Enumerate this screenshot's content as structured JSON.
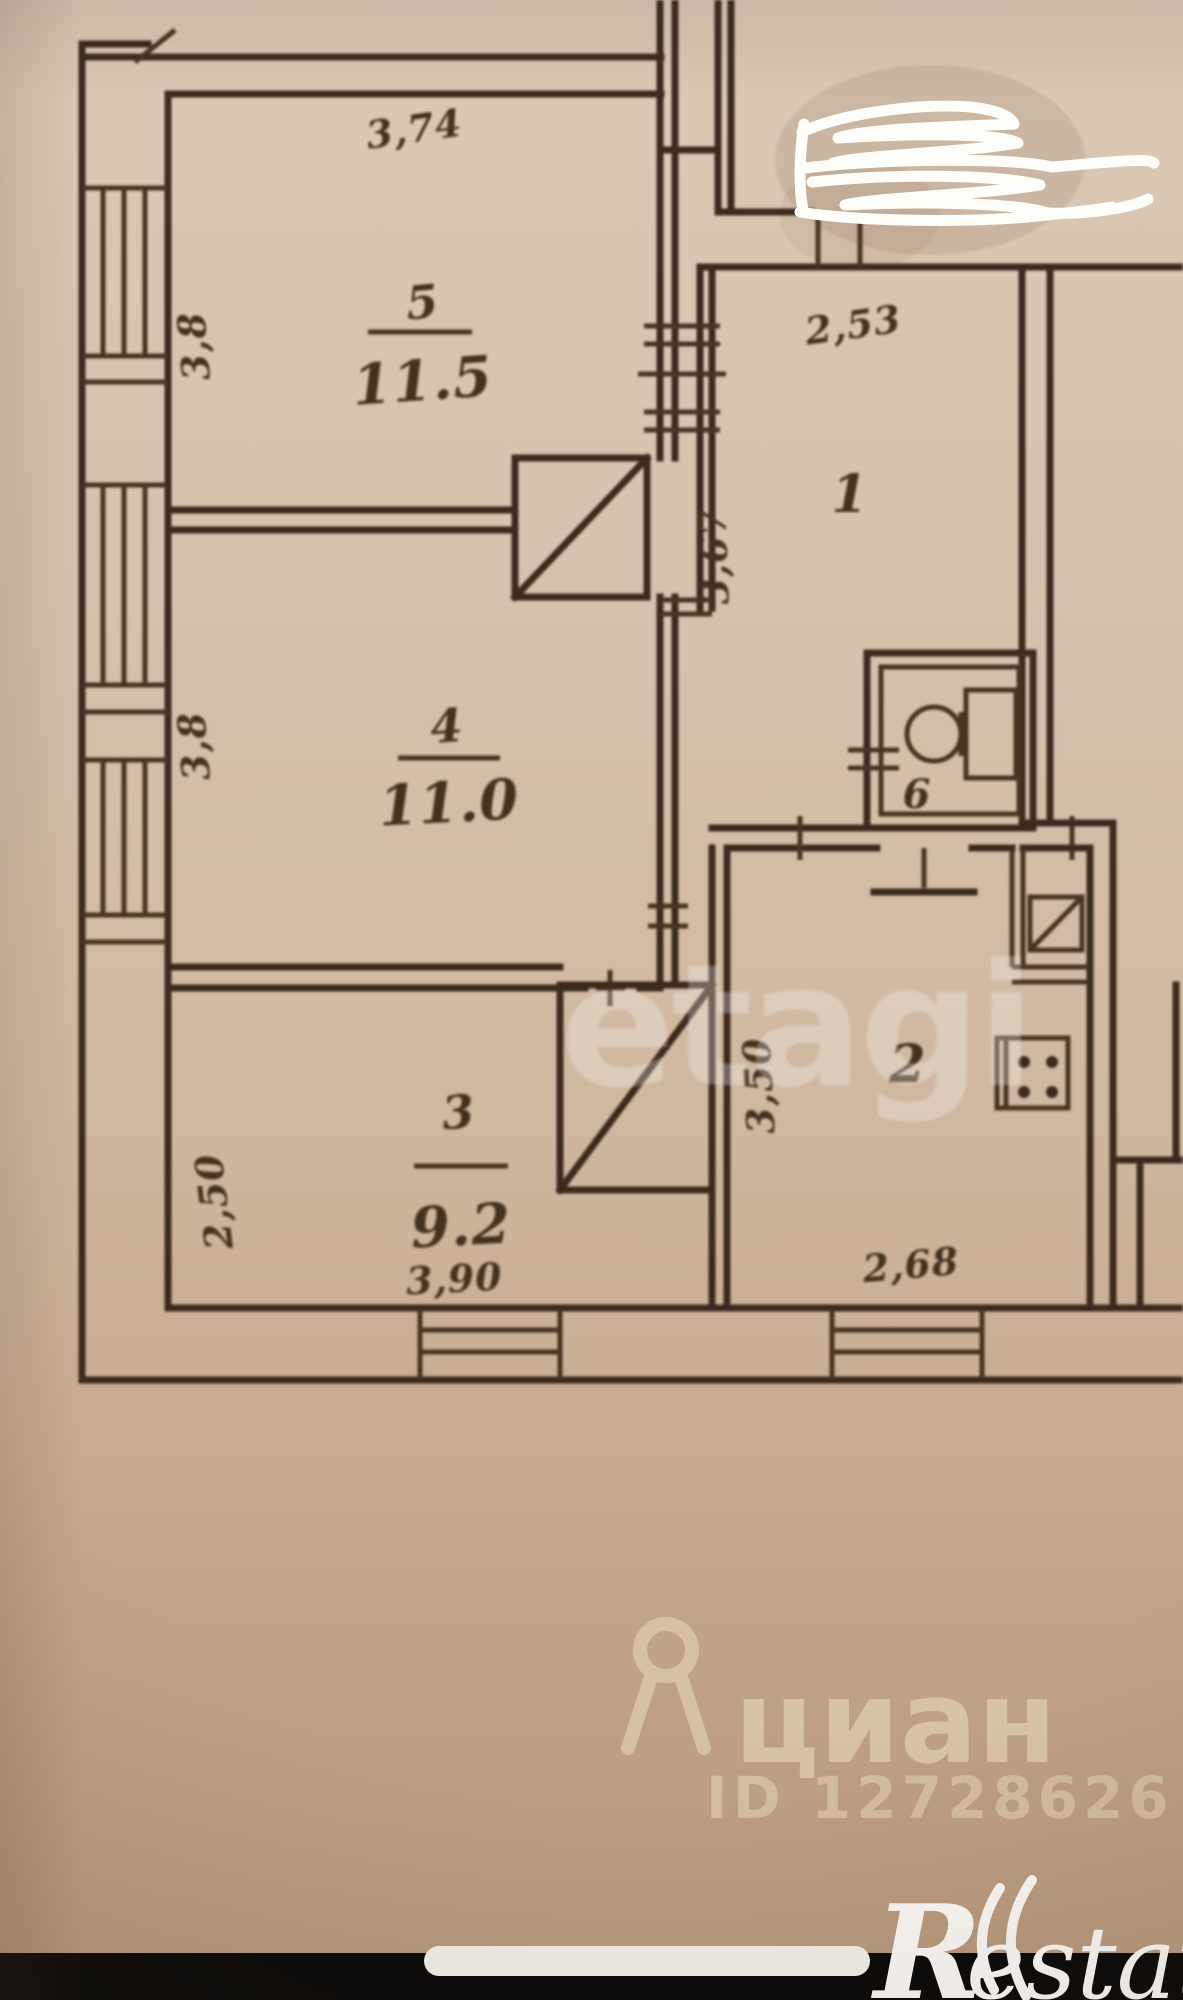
{
  "page": {
    "type": "real-estate floor plan photo"
  },
  "plan": {
    "rooms": [
      {
        "number": "5",
        "area": "11.5"
      },
      {
        "number": "4",
        "area": "11.0"
      },
      {
        "number": "3",
        "area": "9.2"
      },
      {
        "number": "1",
        "area": ""
      },
      {
        "number": "2",
        "area": ""
      },
      {
        "number": "6",
        "area": ""
      }
    ],
    "dimensions": {
      "room5_top": "3,74",
      "room5_left": "3,8",
      "room4_left": "3,8",
      "room3_left": "2,50",
      "room3_bottom": "3,90",
      "room1_top": "2,53",
      "hall_left": "3,67",
      "room2_left": "3,50",
      "room2_bottom": "2,68"
    }
  },
  "watermarks": {
    "etagi": "etagi",
    "cian": {
      "name": "циан",
      "id": "ID 12728626"
    },
    "restate": {
      "initial": "R",
      "rest": "estate"
    }
  },
  "colors": {
    "paper": "#d5c1ab",
    "ink": "#3a281b",
    "watermark_cream": "#dcc9ae",
    "scribble": "#ffffff"
  }
}
